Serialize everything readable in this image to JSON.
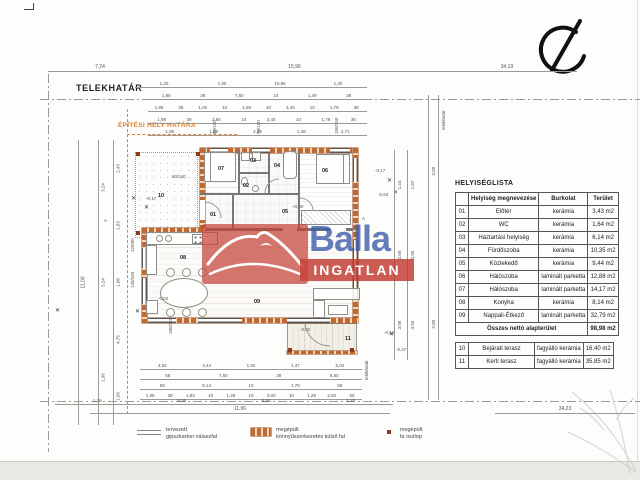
{
  "boundary": {
    "telekhatar_label": "TELEKHATÁR",
    "epitesi_label": "ÉPÍTÉSI HELY HATÁRA"
  },
  "watermark": {
    "brand": "Balla",
    "sub": "INGATLAN"
  },
  "table": {
    "title": "HELYISÉGLISTA",
    "headers": [
      "Helyiség megnevezése",
      "Burkolat",
      "Terület"
    ],
    "rows": [
      {
        "num": "01",
        "name": "Előtér",
        "floor": "kerámia",
        "area": "3,43 m2"
      },
      {
        "num": "02",
        "name": "WC",
        "floor": "kerámia",
        "area": "1,64 m2"
      },
      {
        "num": "03",
        "name": "Háztartási helyiség",
        "floor": "kerámia",
        "area": "6,14 m2"
      },
      {
        "num": "04",
        "name": "Fürdőszoba",
        "floor": "kerámia",
        "area": "10,35 m2"
      },
      {
        "num": "05",
        "name": "Közlekedő",
        "floor": "kerámia",
        "area": "9,44 m2"
      },
      {
        "num": "06",
        "name": "Hálószoba",
        "floor": "laminált parketta",
        "area": "12,88 m2"
      },
      {
        "num": "07",
        "name": "Hálószoba",
        "floor": "laminált parketta",
        "area": "14,17 m2"
      },
      {
        "num": "08",
        "name": "Konyha",
        "floor": "kerámia",
        "area": "8,14 m2"
      },
      {
        "num": "09",
        "name": "Nappali-Étkező",
        "floor": "laminált parketta",
        "area": "32,79 m2"
      }
    ],
    "sum_label": "Összes nettó alapterület",
    "sum_value": "98,98 m2",
    "extra_rows": [
      {
        "num": "10",
        "name": "Bejárati terasz",
        "floor": "fagyálló kerámia",
        "area": "16,40 m2"
      },
      {
        "num": "11",
        "name": "Kerti terasz",
        "floor": "fagyálló kerámia",
        "area": "35,85 m2"
      }
    ]
  },
  "legend": {
    "items": [
      {
        "cls": "sym-partition",
        "l1": "tervezett",
        "l2": "gipszkarton válaszfal"
      },
      {
        "cls": "sym-wall",
        "l1": "megépült",
        "l2": "könnyűszerkezetes külső fal"
      },
      {
        "cls": "sym-post",
        "l1": "megépült",
        "l2": "fa oszlop"
      }
    ]
  },
  "dims": {
    "chains": [
      {
        "x": 48,
        "y": 64,
        "l": 104,
        "o": "h",
        "f": 5,
        "v": [
          "7,24"
        ]
      },
      {
        "x": 152,
        "y": 64,
        "l": 285,
        "o": "h",
        "f": 5,
        "v": [
          "15,96"
        ]
      },
      {
        "x": 437,
        "y": 64,
        "l": 140,
        "o": "h",
        "f": 5,
        "v": [
          "34,19"
        ]
      },
      {
        "x": 135,
        "y": 80,
        "l": 232,
        "o": "h",
        "v": [
          "1,20",
          "1,90",
          "10,86",
          "1,20"
        ]
      },
      {
        "x": 148,
        "y": 92,
        "l": 219,
        "o": "h",
        "v": [
          "1,98",
          "38",
          "7,60",
          "10",
          "1,49",
          "38"
        ]
      },
      {
        "x": 148,
        "y": 104,
        "l": 219,
        "o": "h",
        "v": [
          "1,98",
          "38",
          "1,00",
          "10",
          "1,58",
          "10",
          "3,45",
          "10",
          "1,78",
          "38"
        ]
      },
      {
        "x": 148,
        "y": 116,
        "l": 219,
        "o": "h",
        "v": [
          "1,98",
          "38",
          "2,66",
          "10",
          "3,45",
          "10",
          "1,78",
          "38"
        ]
      },
      {
        "x": 148,
        "y": 128,
        "l": 219,
        "o": "h",
        "v": [
          "1,90",
          "1,98",
          "2,79",
          "1,38",
          "2,71"
        ]
      },
      {
        "x": 140,
        "y": 362,
        "l": 222,
        "o": "h",
        "v": [
          "3,92",
          "4,43",
          "1,92",
          "1,47",
          "5,04"
        ]
      },
      {
        "x": 140,
        "y": 372,
        "l": 222,
        "o": "h",
        "v": [
          "58",
          "7,50",
          "38",
          "6,50"
        ]
      },
      {
        "x": 140,
        "y": 382,
        "l": 222,
        "o": "h",
        "v": [
          "58",
          "8,13",
          "10",
          "1,78",
          "58"
        ]
      },
      {
        "x": 140,
        "y": 392,
        "l": 222,
        "o": "h",
        "v": [
          "1,96",
          "38",
          "1,82",
          "10",
          "1,28",
          "10",
          "3,00",
          "10",
          "1,28",
          "2,50",
          "58"
        ]
      },
      {
        "x": 55,
        "y": 397,
        "l": 338,
        "o": "h",
        "v": [
          "1,19",
          "8,36",
          "6,50",
          "1,20"
        ]
      },
      {
        "x": 90,
        "y": 406,
        "l": 300,
        "o": "h",
        "f": 5,
        "v": [
          "11,96"
        ]
      },
      {
        "x": 495,
        "y": 406,
        "l": 140,
        "o": "h",
        "f": 5,
        "v": [
          "34,23"
        ]
      },
      {
        "x": 78,
        "y": 140,
        "l": 285,
        "o": "v",
        "f": 5,
        "v": [
          "11,00"
        ]
      },
      {
        "x": 98,
        "y": 140,
        "l": 285,
        "o": "v",
        "v": [
          "3,24",
          "5,24",
          "1,96"
        ]
      },
      {
        "x": 113,
        "y": 140,
        "l": 285,
        "o": "v",
        "v": [
          "2,43",
          "1,63",
          "1,08",
          "4,75",
          "1,56"
        ]
      },
      {
        "x": 394,
        "y": 150,
        "l": 210,
        "o": "v",
        "v": [
          "1,44",
          "2,00",
          "3,08"
        ]
      },
      {
        "x": 407,
        "y": 150,
        "l": 210,
        "o": "v",
        "v": [
          "1,87",
          "3,65",
          "3,03"
        ]
      },
      {
        "x": 428,
        "y": 95,
        "l": 305,
        "o": "v",
        "v": [
          "3,00",
          "3,00"
        ]
      },
      {
        "x": 438,
        "y": 95,
        "l": 305,
        "o": "v",
        "v": []
      }
    ]
  },
  "plan": {
    "rooms": [
      {
        "n": "01",
        "x": 210,
        "y": 212
      },
      {
        "n": "02",
        "x": 243,
        "y": 183
      },
      {
        "n": "03",
        "x": 250,
        "y": 158
      },
      {
        "n": "04",
        "x": 274,
        "y": 163
      },
      {
        "n": "05",
        "x": 282,
        "y": 209
      },
      {
        "n": "06",
        "x": 322,
        "y": 168
      },
      {
        "n": "07",
        "x": 218,
        "y": 166
      },
      {
        "n": "08",
        "x": 180,
        "y": 255
      },
      {
        "n": "09",
        "x": 254,
        "y": 299
      },
      {
        "n": "10",
        "x": 158,
        "y": 193
      },
      {
        "n": "11",
        "x": 345,
        "y": 336
      }
    ],
    "annotations": [
      {
        "t": "+0,00",
        "x": 292,
        "y": 204
      },
      {
        "t": "-0,17",
        "x": 375,
        "y": 168
      },
      {
        "t": "-0,53",
        "x": 378,
        "y": 192
      },
      {
        "t": "-0,17",
        "x": 146,
        "y": 196
      },
      {
        "t": "-0,02",
        "x": 158,
        "y": 296
      },
      {
        "t": "-0,52",
        "x": 384,
        "y": 330
      },
      {
        "t": "-0,47",
        "x": 396,
        "y": 347
      },
      {
        "t": "-0,02",
        "x": 300,
        "y": 327
      },
      {
        "t": "60/240",
        "x": 172,
        "y": 174
      },
      {
        "t": "80/150",
        "x": 212,
        "y": 134,
        "r": 1
      },
      {
        "t": "90/150",
        "x": 256,
        "y": 134,
        "r": 1
      },
      {
        "t": "150/150",
        "x": 334,
        "y": 134,
        "r": 1
      },
      {
        "t": "180/240",
        "x": 168,
        "y": 334,
        "r": 1
      },
      {
        "t": "120/240",
        "x": 130,
        "y": 288,
        "r": 1
      },
      {
        "t": "120/60",
        "x": 130,
        "y": 252,
        "r": 1
      },
      {
        "t": "A",
        "x": 104,
        "y": 218
      },
      {
        "t": "A",
        "x": 362,
        "y": 216
      },
      {
        "t": "telekhatár",
        "x": 441,
        "y": 130,
        "r": 1
      },
      {
        "t": "telekhatár",
        "x": 364,
        "y": 380,
        "r": 1
      }
    ],
    "trees": [
      {
        "x": 131,
        "y": 196
      },
      {
        "x": 144,
        "y": 205
      },
      {
        "x": 387,
        "y": 178
      },
      {
        "x": 393,
        "y": 190
      },
      {
        "x": 135,
        "y": 309
      },
      {
        "x": 389,
        "y": 332
      },
      {
        "x": 55,
        "y": 308
      }
    ],
    "posts": [
      {
        "x": 136,
        "y": 152
      },
      {
        "x": 136,
        "y": 231
      },
      {
        "x": 196,
        "y": 152
      },
      {
        "x": 288,
        "y": 348
      },
      {
        "x": 350,
        "y": 348
      }
    ]
  }
}
